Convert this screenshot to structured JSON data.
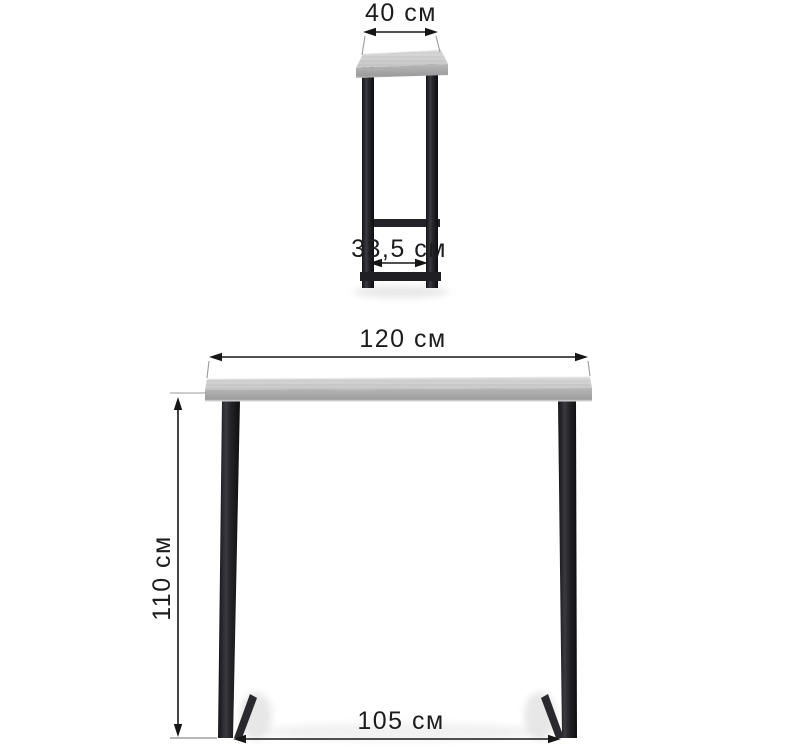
{
  "diagram": {
    "subject": "bar-table-dimension-drawing",
    "unit": "см",
    "side_view": {
      "labels": {
        "top_width": "40 см",
        "inner_width": "33,5 см"
      },
      "values": {
        "depth_cm": 40,
        "inner_depth_cm": 33.5
      }
    },
    "front_view": {
      "labels": {
        "top_width": "120 см",
        "height": "110 см",
        "inner_width": "105 см"
      },
      "values": {
        "width_cm": 120,
        "height_cm": 110,
        "inner_width_cm": 105
      }
    },
    "colors": {
      "background": "#ffffff",
      "dimension_line": "#161616",
      "extension_line": "#9b9b9b",
      "label_text": "#1d1d1d",
      "tabletop_light": "#d6d6d6",
      "tabletop_edge": "#a6a6a6",
      "metal_leg": "#1c1c1f",
      "shadow": "#dddddd"
    }
  }
}
